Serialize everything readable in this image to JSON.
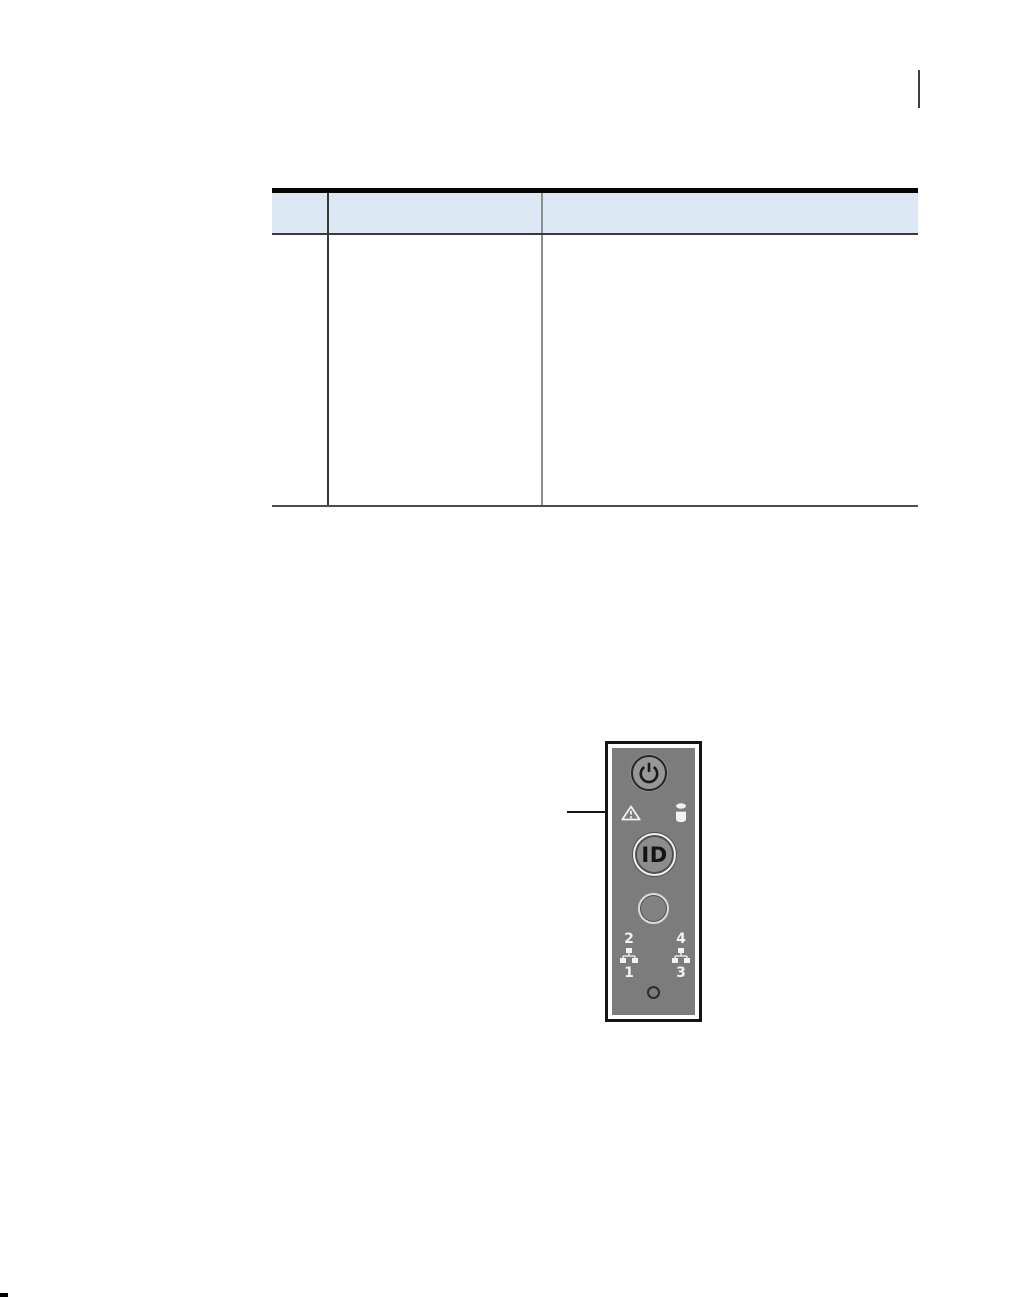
{
  "document": {
    "table": {
      "header_cells": [
        "",
        "",
        ""
      ],
      "body_cells": [
        "",
        "",
        ""
      ],
      "header_bg_color": "#dce9f5",
      "top_rule_color": "#050505"
    },
    "figure": {
      "panel": {
        "id_button_label": "ID",
        "nic_top_left": "2",
        "nic_top_right": "4",
        "nic_bottom_left": "1",
        "nic_bottom_right": "3",
        "face_color": "#7c7c7c",
        "frame_color": "#151515",
        "icon_color": "#f2f2f2",
        "icons": [
          "power-icon",
          "warning-icon",
          "drive-activity-icon",
          "network-icon"
        ]
      }
    }
  }
}
